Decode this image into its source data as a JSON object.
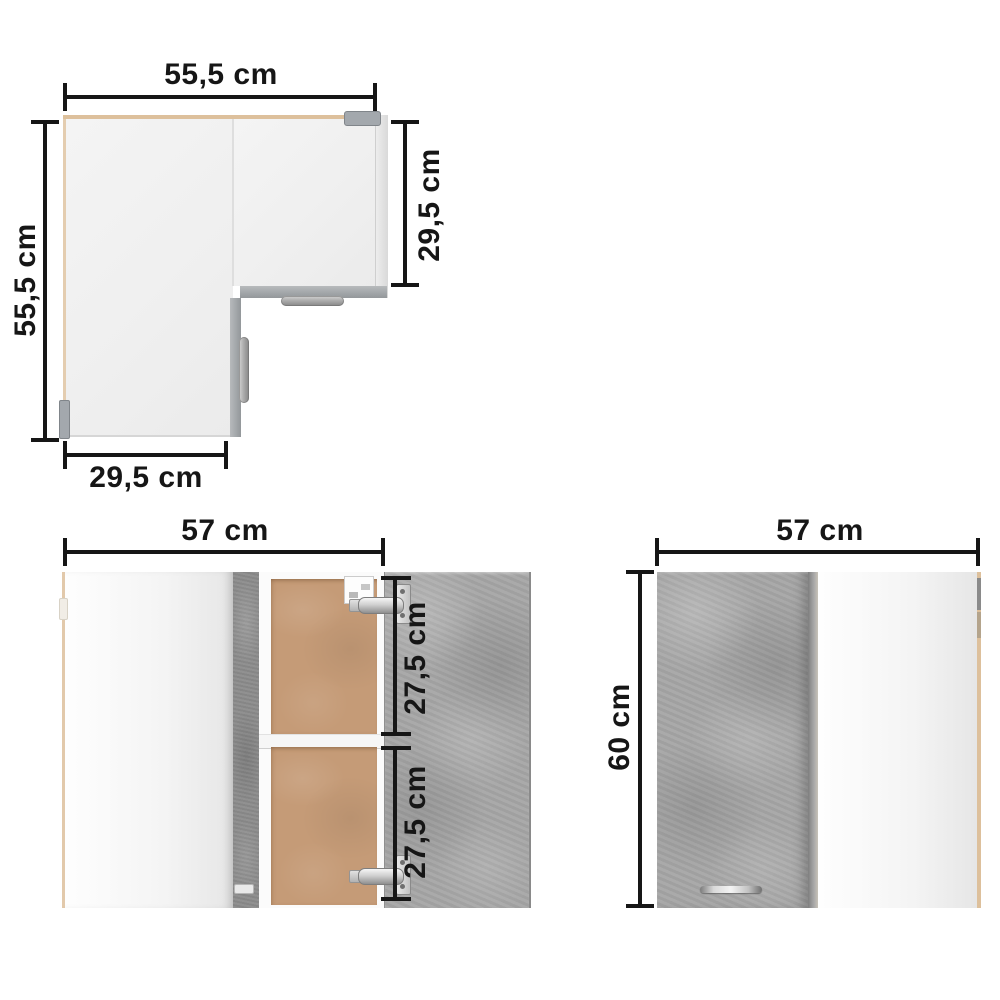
{
  "colors": {
    "background": "#ffffff",
    "dimension_line": "#161616",
    "label_text": "#161616",
    "concrete_gray": "#a7a7a7",
    "concrete_edge_dark": "#8d8d8d",
    "carcass_white": "#fbfbfb",
    "interior_tan": "#c59b77",
    "edge_tan": "#ddc09c",
    "hardware_gray": "#a3a8ad"
  },
  "views": {
    "top_view": {
      "dims": {
        "top_width": "55,5 cm",
        "left_depth": "55,5 cm",
        "right_depth": "29,5 cm",
        "bottom_width": "29,5 cm"
      }
    },
    "front_open_view": {
      "dims": {
        "width": "57 cm",
        "upper_compartment": "27,5 cm",
        "lower_compartment": "27,5 cm"
      }
    },
    "front_closed_view": {
      "dims": {
        "width": "57 cm",
        "height": "60 cm"
      }
    }
  }
}
